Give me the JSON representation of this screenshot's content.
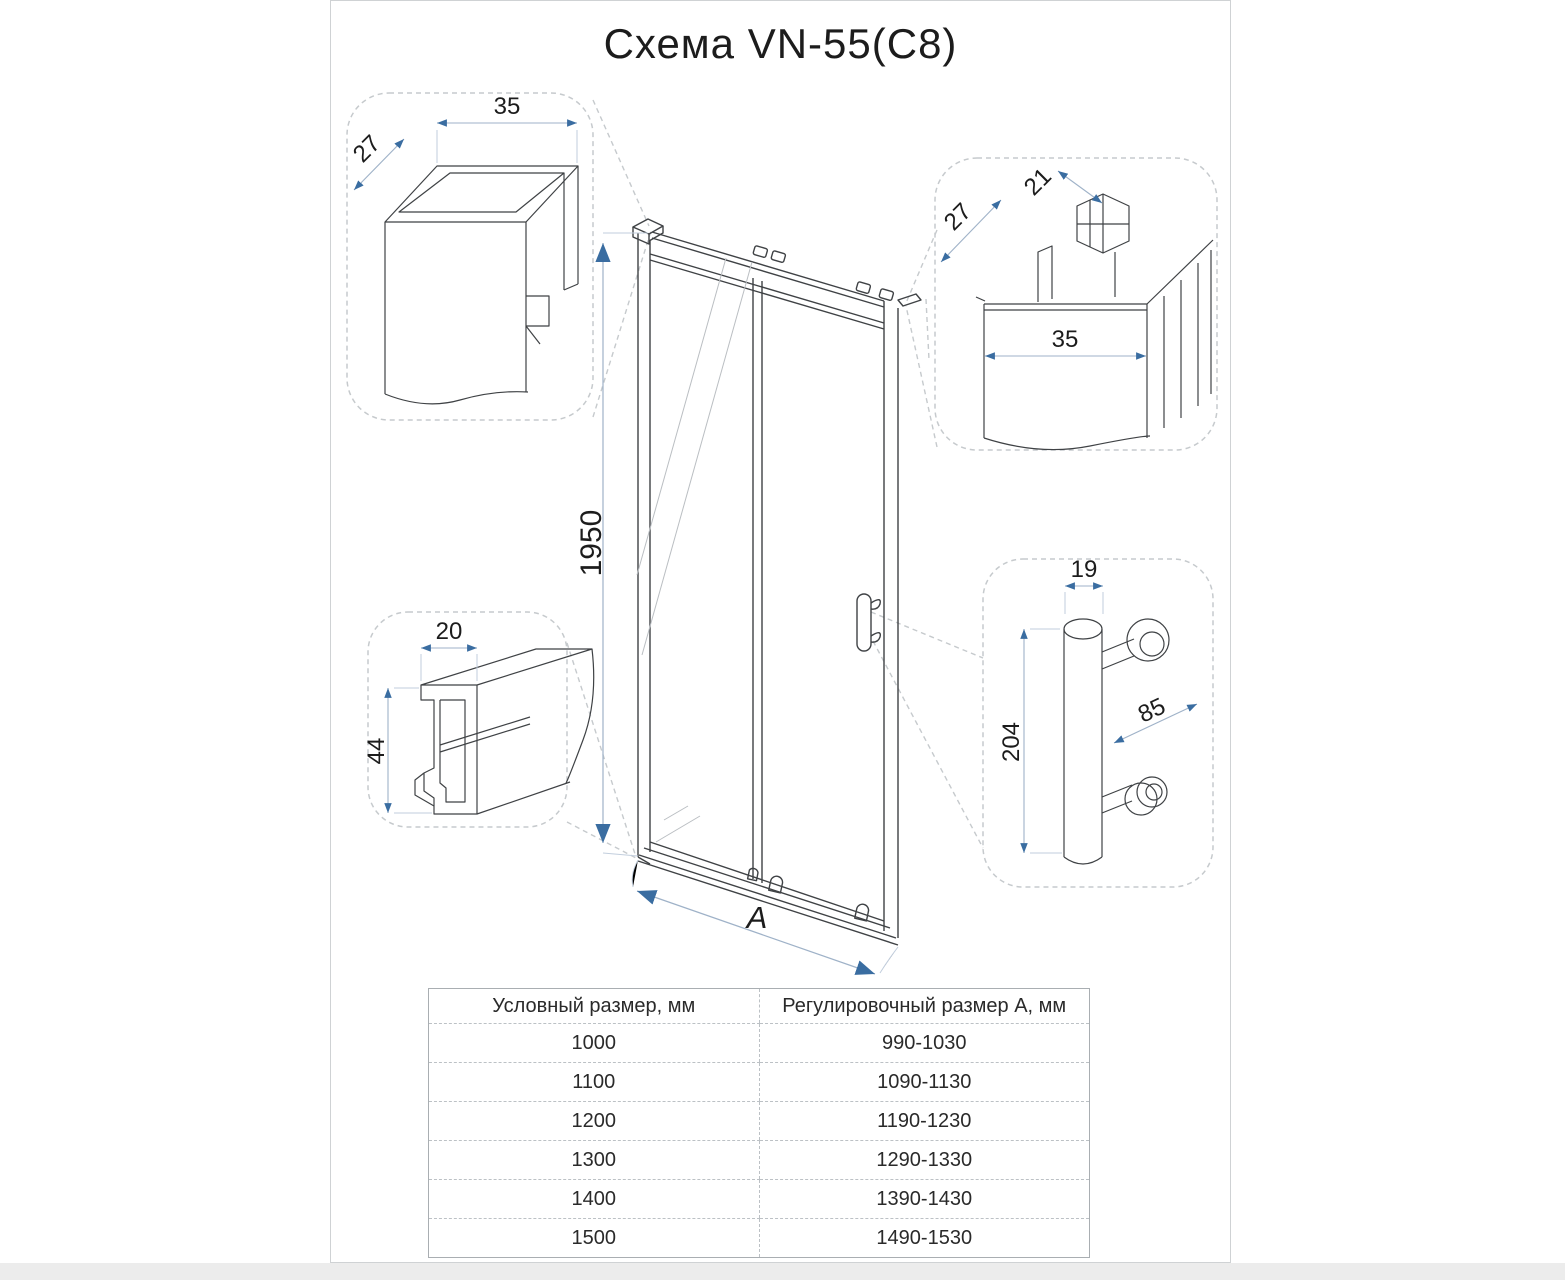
{
  "title": "Схема VN-55(C8)",
  "main": {
    "height_dim": "1950",
    "width_dim": "A"
  },
  "details": {
    "wall_profile_left": {
      "width": "35",
      "depth": "27"
    },
    "wall_profile_right": {
      "clip_width": "21",
      "depth": "27",
      "width": "35"
    },
    "bottom_rail": {
      "width": "20",
      "height": "44"
    },
    "handle": {
      "diameter": "19",
      "length": "204",
      "mount_spacing": "85"
    }
  },
  "table": {
    "headers": [
      "Условный размер, мм",
      "Регулировочный размер А, мм"
    ],
    "rows": [
      [
        "1000",
        "990-1030"
      ],
      [
        "1100",
        "1090-1130"
      ],
      [
        "1200",
        "1190-1230"
      ],
      [
        "1300",
        "1290-1330"
      ],
      [
        "1400",
        "1390-1430"
      ],
      [
        "1500",
        "1490-1530"
      ]
    ]
  },
  "colors": {
    "dim_arrow": "#3a6da1",
    "dim_line": "#9fb2c8",
    "drawing_line": "#3f4245",
    "dash_line": "#c6cacd",
    "strip": "#ececec"
  }
}
